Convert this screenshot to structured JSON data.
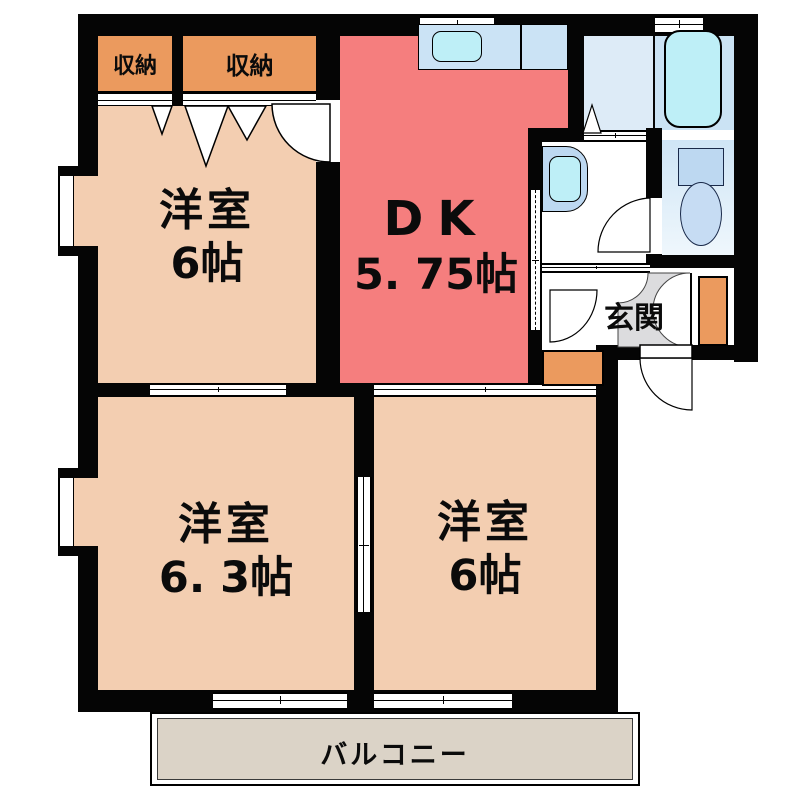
{
  "rooms": {
    "western_top_left": {
      "name": "洋室",
      "size": "6帖"
    },
    "dk": {
      "name": "DK",
      "size": "5. 75帖"
    },
    "western_bottom_left": {
      "name": "洋室",
      "size": "6. 3帖"
    },
    "western_bottom_right": {
      "name": "洋室",
      "size": "6帖"
    }
  },
  "storage": {
    "closet_left": "収納",
    "closet_right": "収納"
  },
  "entrance": {
    "label": "玄関"
  },
  "balcony": {
    "label": "バルコニー"
  },
  "colors": {
    "room_peach": "#F3CEB1",
    "closet_orange": "#EB9A5E",
    "dk_red": "#F57E7E",
    "counter_blue": "#CBE3F5",
    "washroom_blue": "#DDEBF7",
    "fixture_cyan": "#BEEFF7",
    "unit_blue": "#BDD8F1",
    "tataki_gray": "#DCDCDE",
    "balcony_beige": "#DBD3C7",
    "wall_black": "#050505"
  }
}
